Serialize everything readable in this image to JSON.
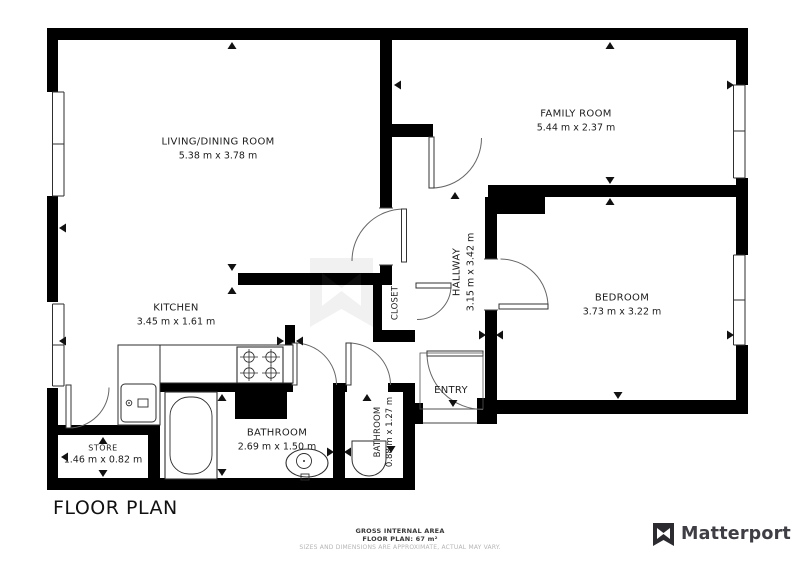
{
  "title": "FLOOR PLAN",
  "rooms": {
    "living": {
      "name": "LIVING/DINING ROOM",
      "dims": "5.38 m x 3.78 m"
    },
    "family": {
      "name": "FAMILY ROOM",
      "dims": "5.44 m x 2.37 m"
    },
    "kitchen": {
      "name": "KITCHEN",
      "dims": "3.45 m x 1.61 m"
    },
    "bedroom": {
      "name": "BEDROOM",
      "dims": "3.73 m x 3.22 m"
    },
    "hallway": {
      "name": "HALLWAY",
      "dims": "3.15 m x 3.42 m"
    },
    "closet": {
      "name": "CLOSET"
    },
    "entry": {
      "name": "ENTRY"
    },
    "bathroom": {
      "name": "BATHROOM",
      "dims": "2.69 m x 1.50 m"
    },
    "bathroom2": {
      "name": "BATHROOM",
      "dims": "0.88 m x 1.27 m"
    },
    "store": {
      "name": "STORE",
      "dims": "1.46 m x 0.82 m"
    }
  },
  "footer": {
    "gross_area_label": "GROSS INTERNAL AREA",
    "floor_plan_area": "FLOOR PLAN: 67 m²",
    "disclaimer": "SIZES AND DIMENSIONS ARE APPROXIMATE, ACTUAL MAY VARY."
  },
  "branding": {
    "logo_text": "Matterport"
  },
  "colors": {
    "wall": "#000000",
    "line": "#2e2e2e",
    "label": "#1c1c1c",
    "disclaimer": "#b5b5b5",
    "brand": "#3e3e44"
  }
}
